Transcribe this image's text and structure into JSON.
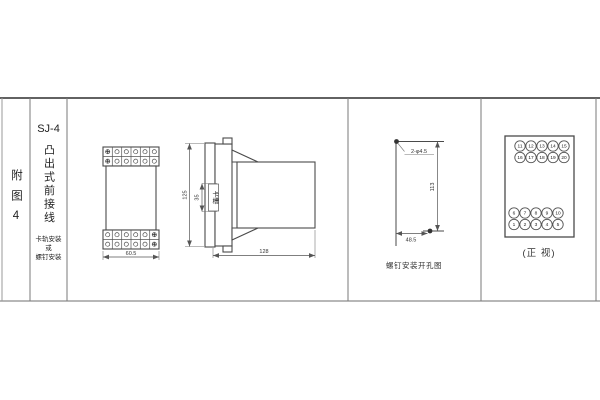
{
  "figure": {
    "index_label": "附图4",
    "title": "SJ-4",
    "subtitle_vertical": "凸出式前接线",
    "mount_note_line1": "卡轨安装",
    "mount_note_line2": "或",
    "mount_note_line3": "螺钉安装"
  },
  "front_view": {
    "width_dim": "60.5"
  },
  "side_view": {
    "height_dim": "125",
    "slot_dim": "35",
    "slot_label": "卡槽",
    "depth_dim": "128"
  },
  "drill_view": {
    "holes_label": "2-φ4.5",
    "vertical_dim": "113",
    "horizontal_dim": "48.5",
    "caption": "螺钉安装开孔图"
  },
  "terminal_view": {
    "caption": "(正 视)",
    "top_rows": [
      [
        "11",
        "12",
        "13",
        "14",
        "15"
      ],
      [
        "16",
        "17",
        "18",
        "19",
        "20"
      ]
    ],
    "bottom_rows": [
      [
        "6",
        "7",
        "8",
        "9",
        "10"
      ],
      [
        "1",
        "2",
        "3",
        "4",
        "5"
      ]
    ]
  }
}
